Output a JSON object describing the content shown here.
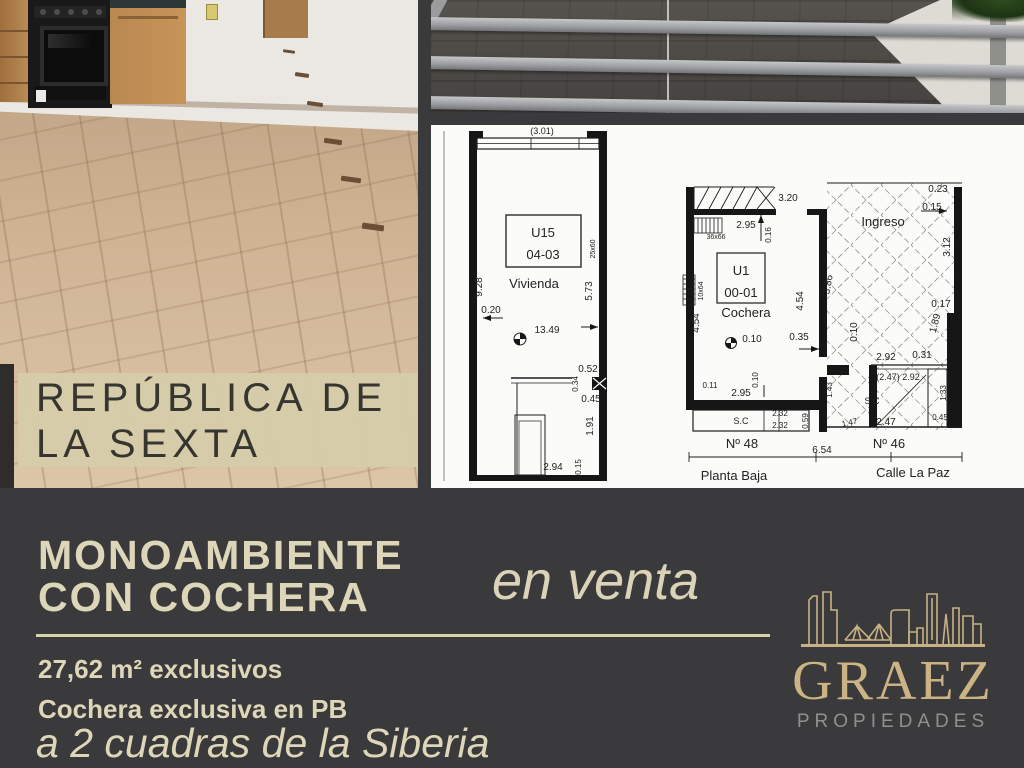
{
  "banner": {
    "location_line1": "REPÚBLICA DE",
    "location_line2": "LA SEXTA"
  },
  "listing": {
    "title_line1": "MONOAMBIENTE",
    "title_line2": "CON COCHERA",
    "status": "en venta",
    "feature_area": "27,62 m² exclusivos",
    "feature_garage": "Cochera exclusiva en PB",
    "tagline": "a 2 cuadras de la Siberia"
  },
  "brand": {
    "name": "GRAEZ",
    "subtitle": "PROPIEDADES"
  },
  "floorplan": {
    "labels": [
      {
        "t": "(3.01)",
        "x": 111,
        "y": 9,
        "s": 9
      },
      {
        "t": "U15",
        "x": 112,
        "y": 112,
        "s": 13
      },
      {
        "t": "04-03",
        "x": 112,
        "y": 134,
        "s": 13
      },
      {
        "t": "Vivienda",
        "x": 103,
        "y": 163,
        "s": 13
      },
      {
        "t": "9.28",
        "x": 51,
        "y": 162,
        "r": -90,
        "s": 10
      },
      {
        "t": "5.73",
        "x": 161,
        "y": 166,
        "r": -90,
        "s": 10
      },
      {
        "t": "25x60",
        "x": 164,
        "y": 124,
        "r": -90,
        "s": 7
      },
      {
        "t": "0.20",
        "x": 60,
        "y": 188,
        "s": 10
      },
      {
        "t": "13.49",
        "x": 116,
        "y": 208,
        "s": 10
      },
      {
        "t": "0.52",
        "x": 157,
        "y": 247,
        "s": 10
      },
      {
        "t": "0.34",
        "x": 147,
        "y": 259,
        "r": -90,
        "s": 8
      },
      {
        "t": "0.45",
        "x": 160,
        "y": 277,
        "s": 10
      },
      {
        "t": "1.91",
        "x": 162,
        "y": 301,
        "r": -90,
        "s": 10
      },
      {
        "t": "0.15",
        "x": 150,
        "y": 342,
        "r": -90,
        "s": 8
      },
      {
        "t": "2.94",
        "x": 122,
        "y": 345,
        "s": 10
      },
      {
        "t": "3.20",
        "x": 357,
        "y": 76,
        "s": 10
      },
      {
        "t": "2.95",
        "x": 315,
        "y": 103,
        "s": 10
      },
      {
        "t": "0.16",
        "x": 340,
        "y": 110,
        "r": -90,
        "s": 8
      },
      {
        "t": "36x66",
        "x": 285,
        "y": 114,
        "s": 7
      },
      {
        "t": "U1",
        "x": 310,
        "y": 150,
        "s": 13
      },
      {
        "t": "00-01",
        "x": 310,
        "y": 172,
        "s": 13
      },
      {
        "t": "Cochera",
        "x": 315,
        "y": 192,
        "s": 13
      },
      {
        "t": "10x64",
        "x": 272,
        "y": 166,
        "r": -90,
        "s": 7
      },
      {
        "t": "4.54",
        "x": 268,
        "y": 198,
        "r": -90,
        "s": 10
      },
      {
        "t": "4.54",
        "x": 372,
        "y": 176,
        "r": -90,
        "s": 10
      },
      {
        "t": "0.10",
        "x": 321,
        "y": 217,
        "s": 10
      },
      {
        "t": "0.35",
        "x": 368,
        "y": 215,
        "s": 10
      },
      {
        "t": "0.10",
        "x": 327,
        "y": 255,
        "r": -90,
        "s": 8
      },
      {
        "t": "0.11",
        "x": 279,
        "y": 263,
        "s": 8
      },
      {
        "t": "2.95",
        "x": 310,
        "y": 271,
        "s": 10
      },
      {
        "t": "S.C",
        "x": 310,
        "y": 299,
        "s": 9
      },
      {
        "t": "2.32",
        "x": 349,
        "y": 291,
        "s": 8
      },
      {
        "t": "2.32",
        "x": 349,
        "y": 303,
        "s": 8
      },
      {
        "t": "0.59",
        "x": 377,
        "y": 296,
        "r": -90,
        "s": 8
      },
      {
        "t": "Ingreso",
        "x": 452,
        "y": 101,
        "s": 13
      },
      {
        "t": "0.23",
        "x": 507,
        "y": 67,
        "s": 10
      },
      {
        "t": "0.15",
        "x": 501,
        "y": 85,
        "s": 10
      },
      {
        "t": "3.12",
        "x": 519,
        "y": 122,
        "r": -90,
        "s": 10
      },
      {
        "t": "3.86",
        "x": 400,
        "y": 160,
        "r": -80,
        "s": 10
      },
      {
        "t": "0.17",
        "x": 510,
        "y": 182,
        "s": 10
      },
      {
        "t": "1.89",
        "x": 507,
        "y": 199,
        "r": -75,
        "s": 10
      },
      {
        "t": "0.10",
        "x": 426,
        "y": 207,
        "r": -90,
        "s": 10
      },
      {
        "t": "2.92",
        "x": 455,
        "y": 235,
        "s": 10
      },
      {
        "t": "0.31",
        "x": 491,
        "y": 233,
        "s": 10
      },
      {
        "t": "(2.47) 2.92",
        "x": 467,
        "y": 255,
        "s": 9
      },
      {
        "t": "1.43",
        "x": 401,
        "y": 265,
        "r": -90,
        "s": 8
      },
      {
        "t": "S.C",
        "x": 441,
        "y": 279,
        "s": 9
      },
      {
        "t": "1.47",
        "x": 419,
        "y": 300,
        "r": -12,
        "s": 8
      },
      {
        "t": "2.47",
        "x": 455,
        "y": 300,
        "s": 10
      },
      {
        "t": "1.33",
        "x": 515,
        "y": 268,
        "r": -90,
        "s": 8
      },
      {
        "t": "0.45",
        "x": 509,
        "y": 295,
        "s": 8
      },
      {
        "t": "Nº 48",
        "x": 311,
        "y": 323,
        "s": 13
      },
      {
        "t": "6.54",
        "x": 391,
        "y": 328,
        "s": 10
      },
      {
        "t": "Nº 46",
        "x": 458,
        "y": 323,
        "s": 13
      },
      {
        "t": "Planta Baja",
        "x": 303,
        "y": 355,
        "s": 13
      },
      {
        "t": "Calle La Paz",
        "x": 482,
        "y": 352,
        "s": 13
      }
    ]
  },
  "colors": {
    "background": "#3a393b",
    "accent_beige": "#ded6b8",
    "banner_beige": "#d6cca9",
    "brand_gold": "#cbb383",
    "brand_gray": "#90908e",
    "plan_ink": "#1d1d1d"
  }
}
